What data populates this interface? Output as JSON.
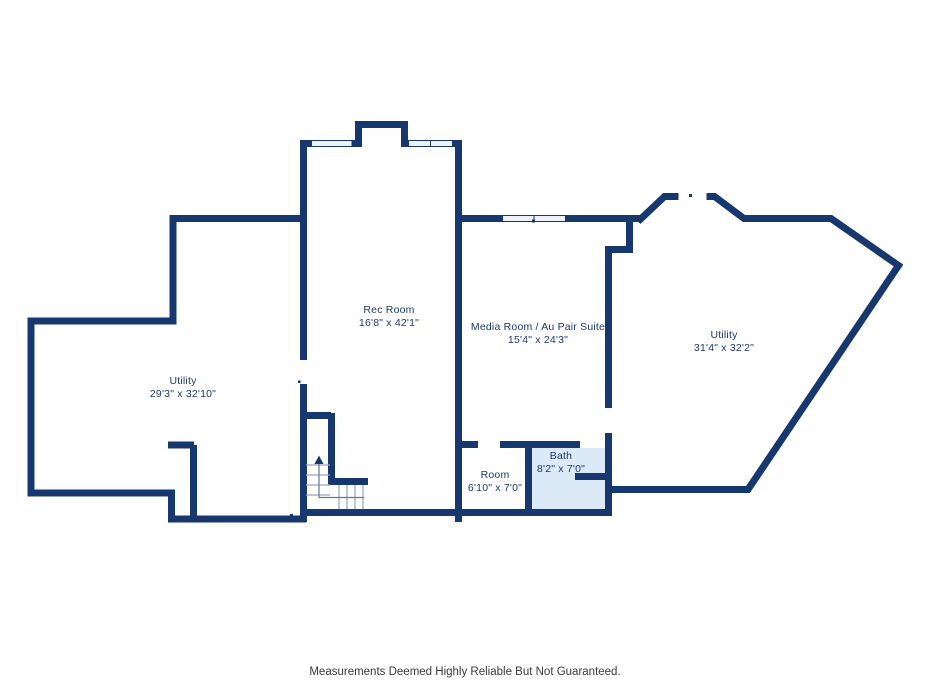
{
  "plan": {
    "rooms": {
      "rec_room": {
        "name": "Rec Room",
        "dims": "16'8\" x 42'1\""
      },
      "media_room": {
        "name": "Media Room / Au Pair Suite",
        "dims": "15'4\" x 24'3\""
      },
      "utility_right": {
        "name": "Utility",
        "dims": "31'4\" x 32'2\""
      },
      "utility_left": {
        "name": "Utility",
        "dims": "29'3\" x 32'10\""
      },
      "room": {
        "name": "Room",
        "dims": "6'10\" x 7'0\""
      },
      "bath": {
        "name": "Bath",
        "dims": "8'2\" x 7'0\""
      }
    },
    "colors": {
      "wall": "#17386e",
      "bath_fill": "#dce9f6",
      "label_text": "#1b3a6b"
    }
  },
  "footer": {
    "disclaimer": "Measurements Deemed Highly Reliable But Not Guaranteed."
  }
}
